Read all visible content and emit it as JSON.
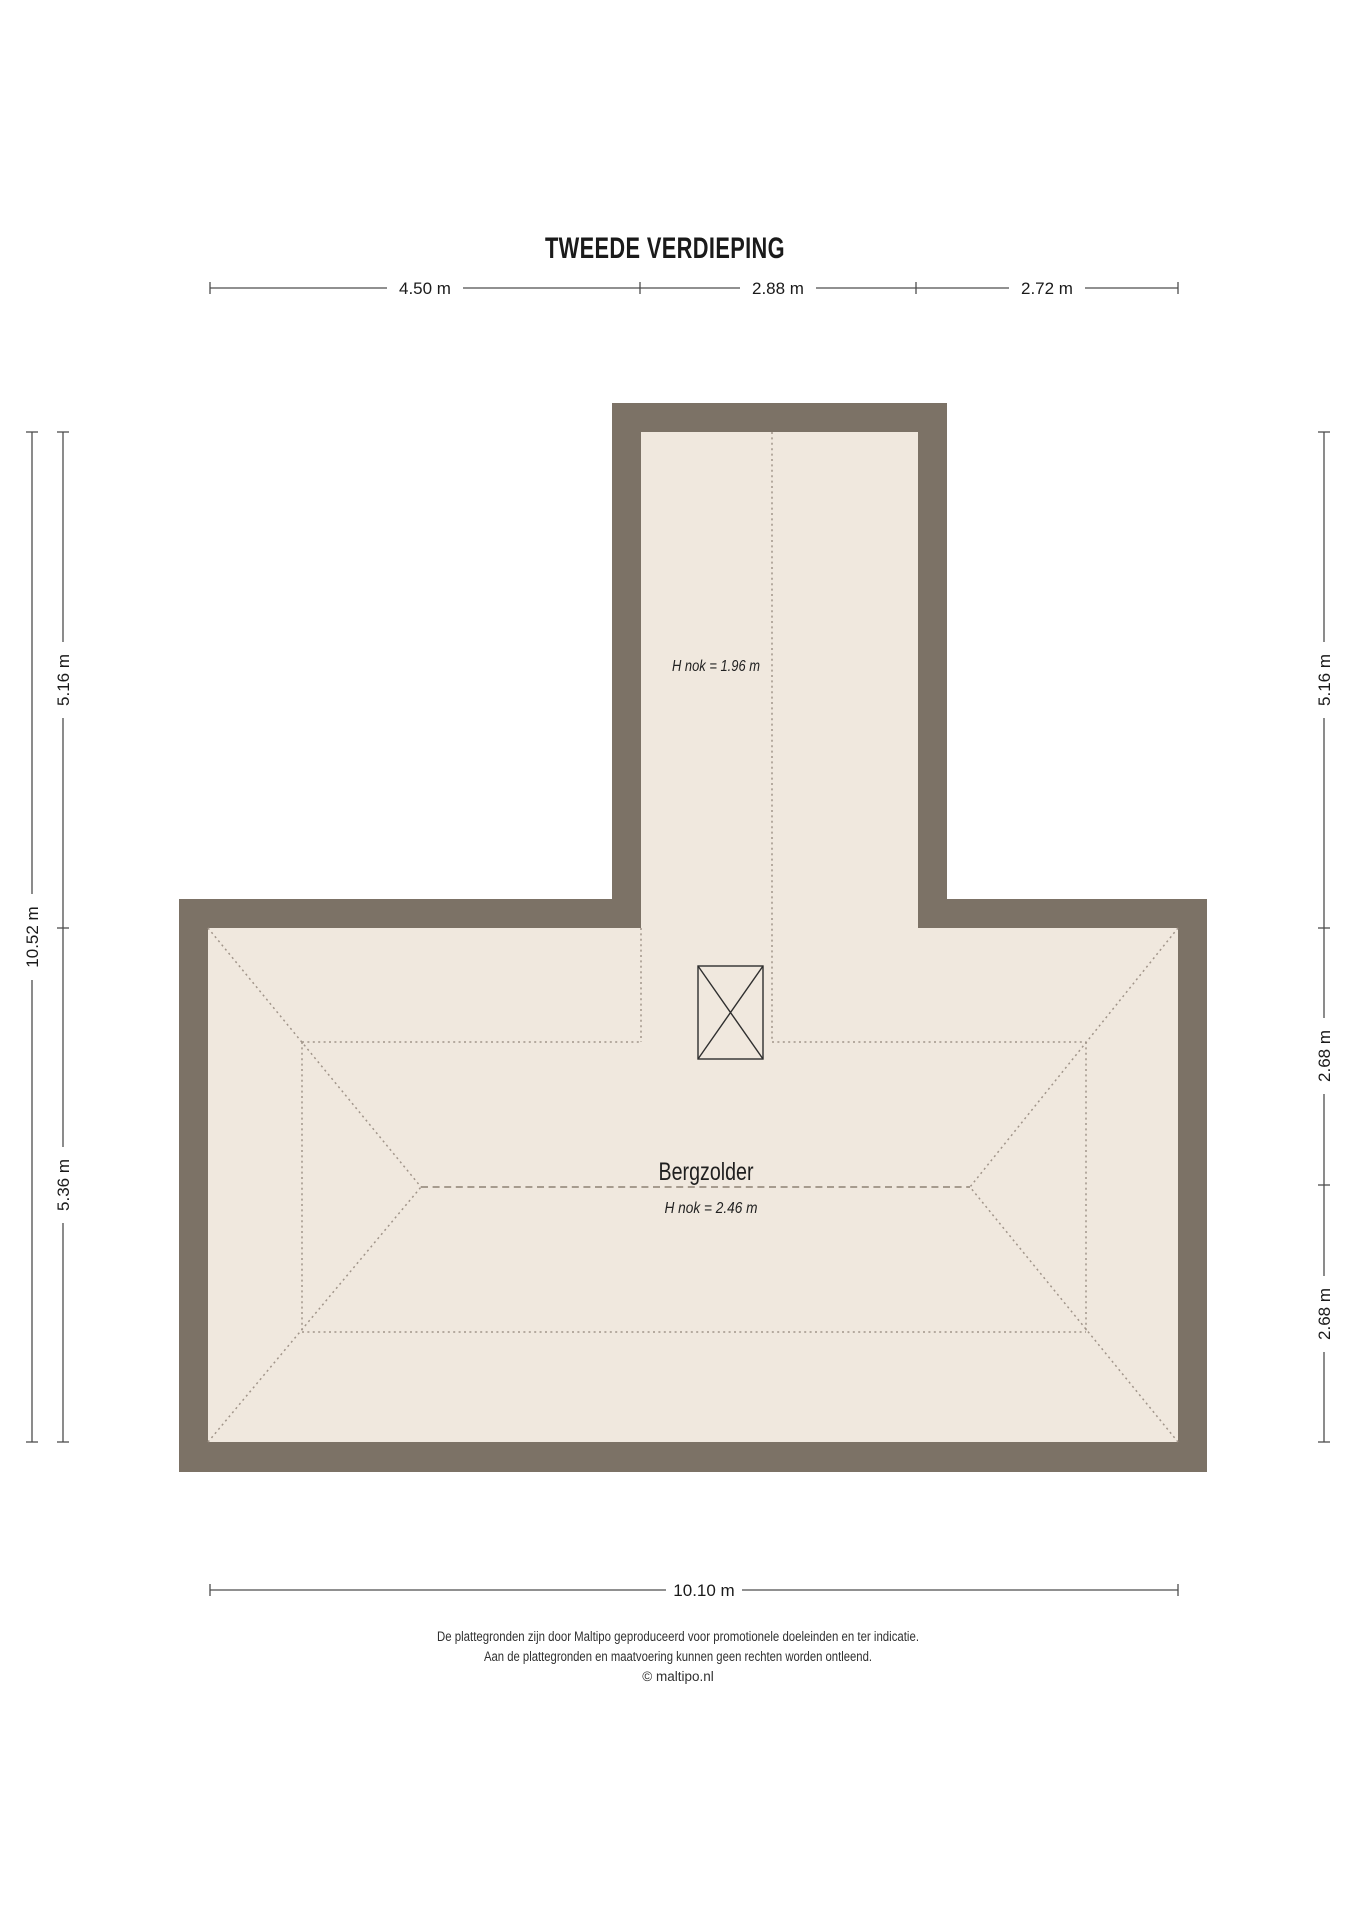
{
  "title": "TWEEDE VERDIEPING",
  "floorplan": {
    "room_label": "Bergzolder",
    "room_ridge_note": "H nok = 2.46 m",
    "corridor_ridge_note": "H nok = 1.96 m",
    "wall_color": "#7c7266",
    "floor_color": "#f0e8de",
    "roof_line_color": "#a1958a"
  },
  "dimensions": {
    "top": [
      "4.50 m",
      "2.88 m",
      "2.72 m"
    ],
    "bottom": "10.10 m",
    "left_outer": "10.52 m",
    "left_inner": [
      "5.16 m",
      "5.36 m"
    ],
    "right": [
      "5.16 m",
      "2.68 m",
      "2.68 m"
    ]
  },
  "footer": {
    "line1": "De plattegronden zijn door Maltipo geproduceerd voor promotionele doeleinden en ter indicatie.",
    "line2": "Aan de plattegronden en maatvoering kunnen geen rechten worden ontleend.",
    "line3": "© maltipo.nl"
  }
}
